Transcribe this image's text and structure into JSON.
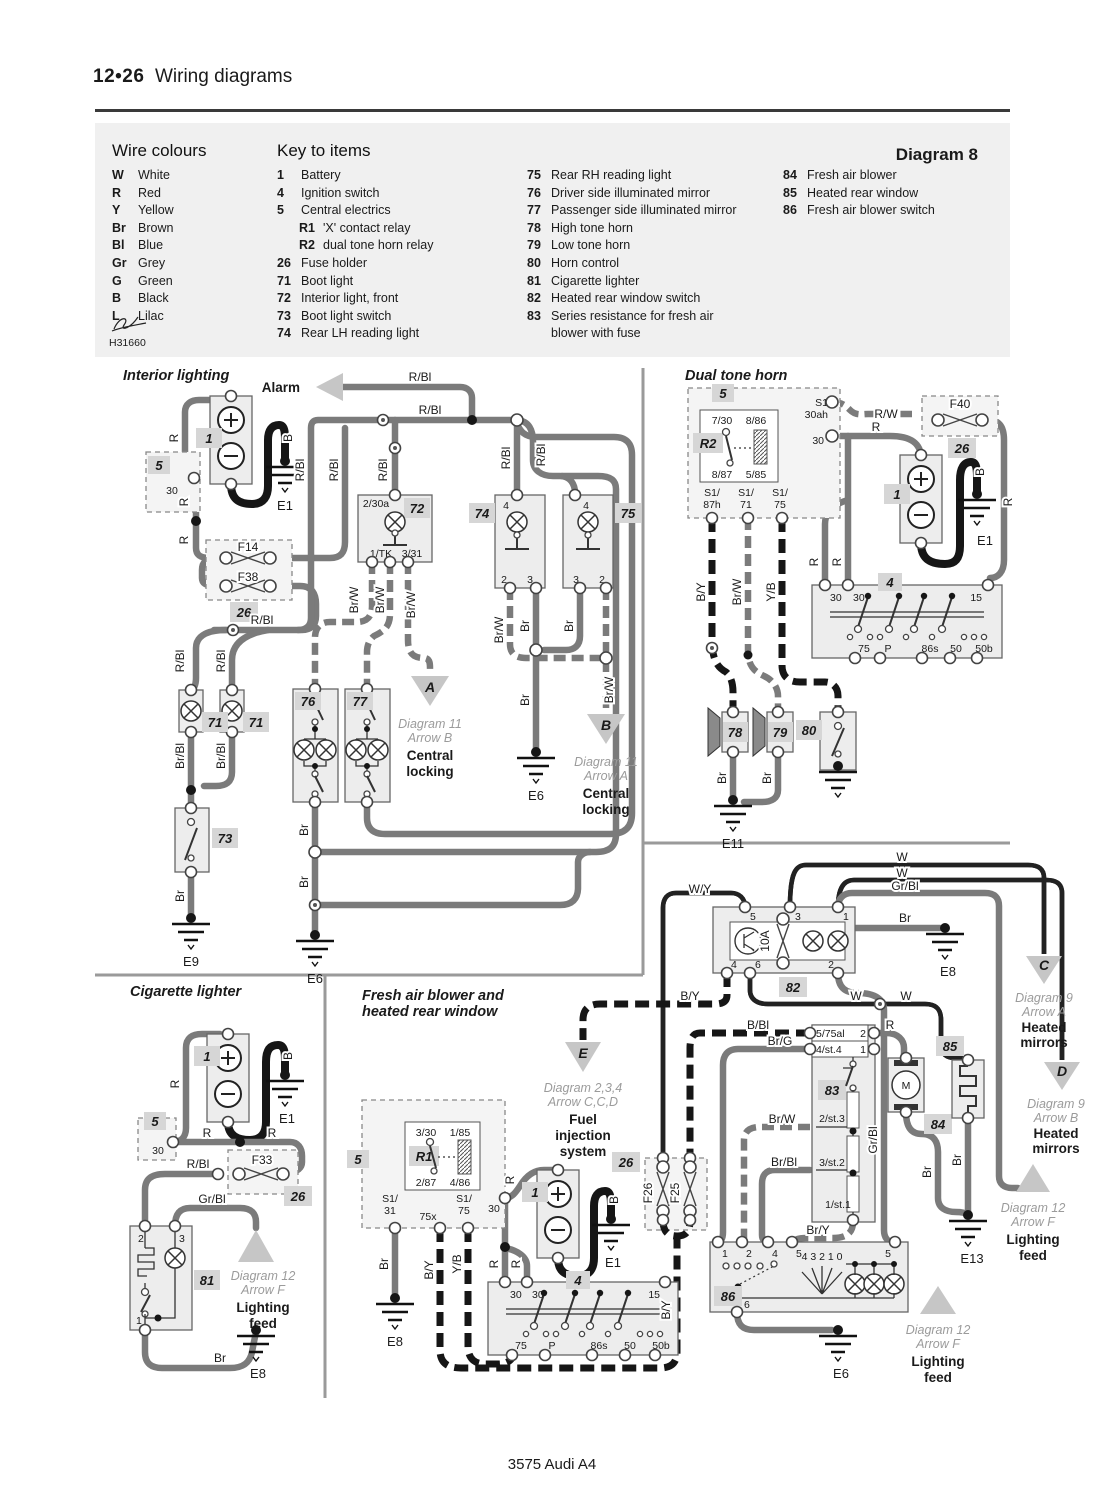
{
  "header": {
    "num": "12•26",
    "title": "Wiring diagrams"
  },
  "footer": "3575 Audi A4",
  "legend": {
    "wire_title": "Wire colours",
    "key_title": "Key to items",
    "diagram": "Diagram 8",
    "sig": "H31660",
    "colours": [
      [
        "W",
        "White"
      ],
      [
        "R",
        "Red"
      ],
      [
        "Y",
        "Yellow"
      ],
      [
        "Br",
        "Brown"
      ],
      [
        "Bl",
        "Blue"
      ],
      [
        "Gr",
        "Grey"
      ],
      [
        "G",
        "Green"
      ],
      [
        "B",
        "Black"
      ],
      [
        "L",
        "Lilac"
      ]
    ],
    "key1": [
      [
        "1",
        "Battery"
      ],
      [
        "4",
        "Ignition switch"
      ],
      [
        "5",
        "Central electrics"
      ],
      [
        "R1",
        "'X' contact relay"
      ],
      [
        "R2",
        "dual tone horn relay"
      ],
      [
        "26",
        "Fuse holder"
      ],
      [
        "71",
        "Boot light"
      ],
      [
        "72",
        "Interior light, front"
      ],
      [
        "73",
        "Boot light switch"
      ],
      [
        "74",
        "Rear LH reading light"
      ]
    ],
    "key2": [
      [
        "75",
        "Rear RH reading light"
      ],
      [
        "76",
        "Driver side illuminated mirror"
      ],
      [
        "77",
        "Passenger side illuminated mirror"
      ],
      [
        "78",
        "High tone horn"
      ],
      [
        "79",
        "Low tone horn"
      ],
      [
        "80",
        "Horn control"
      ],
      [
        "81",
        "Cigarette lighter"
      ],
      [
        "82",
        "Heated rear window switch"
      ],
      [
        "83",
        "Series resistance for fresh air"
      ],
      [
        "",
        "blower with fuse"
      ]
    ],
    "key3": [
      [
        "84",
        "Fresh air blower"
      ],
      [
        "85",
        "Heated rear window"
      ],
      [
        "86",
        "Fresh air blower switch"
      ]
    ]
  },
  "t": {
    "interior": "Interior lighting",
    "horn": "Dual tone horn",
    "cig": "Cigarette lighter",
    "fab1": "Fresh air blower and",
    "fab2": "heated rear window",
    "alarm": "Alarm"
  },
  "w": {
    "r": "R",
    "b": "B",
    "wh": "W",
    "rbl": "R/Bl",
    "rw": "R/W",
    "br": "Br",
    "brw": "Br/W",
    "brbl": "Br/Bl",
    "brg": "Br/G",
    "bry": "Br/Y",
    "by": "B/Y",
    "yb": "Y/B",
    "wy": "W/Y",
    "bbl": "B/Bl",
    "grbl": "Gr/Bl"
  },
  "g": {
    "e1": "E1",
    "e6": "E6",
    "e8": "E8",
    "e9": "E9",
    "e11": "E11",
    "e13": "E13"
  },
  "c": {
    "c1": "1",
    "c4": "4",
    "c5": "5",
    "c26": "26",
    "c71": "71",
    "c72": "72",
    "c73": "73",
    "c74": "74",
    "c75": "75",
    "c76": "76",
    "c77": "77",
    "c78": "78",
    "c79": "79",
    "c80": "80",
    "c81": "81",
    "c82": "82",
    "c83": "83",
    "c84": "84",
    "c85": "85",
    "c86": "86",
    "r1": "R1",
    "r2": "R2",
    "m": "M"
  },
  "f": {
    "f14": "F14",
    "f38": "F38",
    "f40": "F40",
    "f33": "F33",
    "f25": "F25",
    "f26": "F26",
    "a10": "10A"
  },
  "p": {
    "n30": "30",
    "n15": "15",
    "n75": "75",
    "pp": "P",
    "n86s": "86s",
    "n50": "50",
    "n50b": "50b",
    "n1": "1",
    "n2": "2",
    "n3": "3",
    "n4": "4",
    "n5": "5",
    "n6": "6",
    "a230": "2/30a",
    "tk": "1/TK",
    "t331": "3/31",
    "p730": "7/30",
    "p886": "8/86",
    "p887": "8/87",
    "p585": "5/85",
    "p330": "3/30",
    "p185": "1/85",
    "p287": "2/87",
    "p486": "4/86",
    "s1": "S1",
    "ah": "30ah",
    "s1s": "S1/",
    "h87": "87h",
    "n71": "71",
    "n31": "31",
    "x75": "75x",
    "al": "5/75al",
    "st4": "4/st.4",
    "st3": "2/st.3",
    "st2": "3/st.2",
    "st1": "1/st.1",
    "rot": "4 3 2 1 0"
  },
  "a": {
    "a": {
      "ltr": "A",
      "l1": "Diagram 11",
      "l2": "Arrow B",
      "l3": "Central",
      "l4": "locking"
    },
    "b": {
      "ltr": "B",
      "l1": "Diagram 11",
      "l2": "Arrow A",
      "l3": "Central",
      "l4": "locking"
    },
    "c": {
      "ltr": "C",
      "l1": "Diagram 9",
      "l2": "Arrow A",
      "l3": "Heated",
      "l4": "mirrors"
    },
    "d": {
      "ltr": "D",
      "l1": "Diagram 9",
      "l2": "Arrow B",
      "l3": "Heated",
      "l4": "mirrors"
    },
    "e": {
      "ltr": "E",
      "l1": "Diagram 2,3,4",
      "l2": "Arrow C,C,D",
      "l3": "Fuel",
      "l4": "injection",
      "l5": "system"
    },
    "f": {
      "l1": "Diagram 12",
      "l2": "Arrow F",
      "l3": "Lighting",
      "l4": "feed"
    }
  }
}
